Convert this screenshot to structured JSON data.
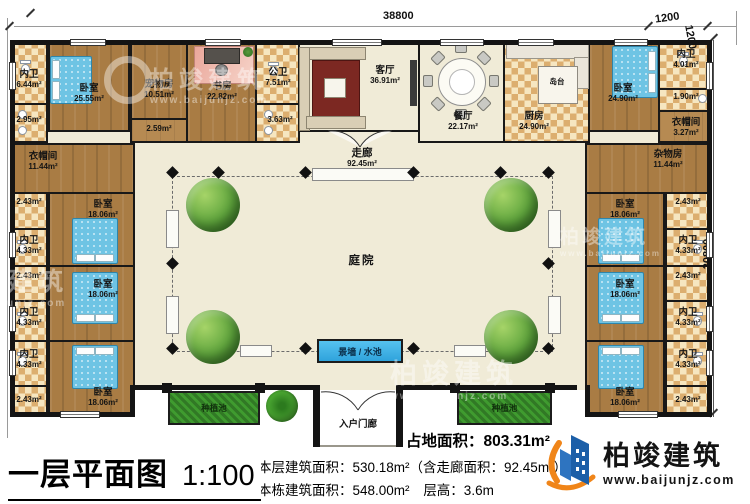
{
  "dims": {
    "width": "38800",
    "height": "20800",
    "offset_top": "1200",
    "offset_side": "1200"
  },
  "rooms": {
    "bath_tl": {
      "name": "内卫",
      "area": "6.44m²"
    },
    "bath_tl_sub": {
      "area": "2.95m²"
    },
    "bed_tl": {
      "name": "卧室",
      "area": "25.55m²"
    },
    "pet": {
      "name": "宠物房",
      "area": "10.51m²"
    },
    "pass259": {
      "area": "2.59m²"
    },
    "study": {
      "name": "书房",
      "area": "22.82m²"
    },
    "pub_bath": {
      "name": "公卫",
      "area": "7.51m²"
    },
    "pub_bath_sub": {
      "area": "3.63m²"
    },
    "living": {
      "name": "客厅",
      "area": "36.91m²"
    },
    "dining": {
      "name": "餐厅",
      "area": "22.17m²"
    },
    "kitchen": {
      "name": "厨房",
      "area": "24.90m²"
    },
    "island": {
      "name": "岛台"
    },
    "bed_tr": {
      "name": "卧室",
      "area": "24.90m²"
    },
    "bath_tr": {
      "name": "内卫",
      "area": "4.01m²"
    },
    "bath_tr_sub": {
      "area": "1.90m²"
    },
    "cloak_tr": {
      "name": "衣帽间",
      "area": "3.27m²"
    },
    "cloak_l": {
      "name": "衣帽间",
      "area": "11.44m²"
    },
    "storage_r": {
      "name": "杂物房",
      "area": "11.44m²"
    },
    "corridor": {
      "name": "走廊",
      "area": "92.45m²"
    },
    "courtyard": {
      "name": "庭院"
    },
    "pool": {
      "name": "景墙 / 水池"
    },
    "planter_l": {
      "name": "种植池"
    },
    "planter_r": {
      "name": "种植池"
    },
    "porch": {
      "name": "入户门廊"
    },
    "l1_closet": {
      "area": "2.43m²"
    },
    "l1_bath": {
      "name": "内卫",
      "area": "4.33m²"
    },
    "l1_bed": {
      "name": "卧室",
      "area": "18.06m²"
    },
    "l2_closet": {
      "area": "2.43m²"
    },
    "l2_bath": {
      "name": "内卫",
      "area": "4.33m²"
    },
    "l2_bed": {
      "name": "卧室",
      "area": "18.06m²"
    },
    "l3_bath": {
      "name": "内卫",
      "area": "4.33m²"
    },
    "l3_closet": {
      "area": "2.43m²"
    },
    "l3_bed": {
      "name": "卧室",
      "area": "18.06m²"
    },
    "r1_closet": {
      "area": "2.43m²"
    },
    "r1_bath": {
      "name": "内卫",
      "area": "4.33m²"
    },
    "r1_bed": {
      "name": "卧室",
      "area": "18.06m²"
    },
    "r2_closet": {
      "area": "2.43m²"
    },
    "r2_bath": {
      "name": "内卫",
      "area": "4.33m²"
    },
    "r2_bed": {
      "name": "卧室",
      "area": "18.06m²"
    },
    "r3_bath": {
      "name": "内卫",
      "area": "4.33m²"
    },
    "r3_closet": {
      "area": "2.43m²"
    },
    "r3_bed": {
      "name": "卧室",
      "area": "18.06m²"
    }
  },
  "footer": {
    "title": "一层平面图",
    "scale": "1:100",
    "land_area": "占地面积：803.31m²",
    "line1": "本层建筑面积：530.18m²（含走廊面积：92.45m²）",
    "line2a": "本栋建筑面积：548.00m²",
    "line2b": "层高：3.6m"
  },
  "brand": {
    "name": "柏竣建筑",
    "site": "www.baijunjz.com"
  },
  "watermark": {
    "name": "柏竣建筑",
    "site": "www.baijunjz.com"
  }
}
